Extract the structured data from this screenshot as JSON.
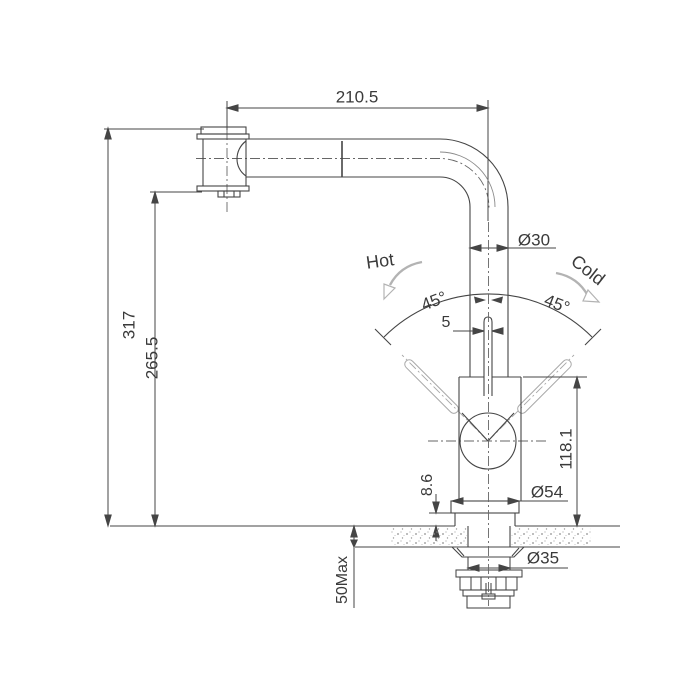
{
  "drawing": {
    "type": "faucet installation technical drawing",
    "labels": {
      "hot": "Hot",
      "cold": "Cold"
    },
    "dimensions": {
      "spout_reach": "210.5",
      "total_height": "317",
      "spout_height": "265.5",
      "pipe_diameter": "Ø30",
      "handle_width": "5",
      "handle_angle_left": "45°",
      "handle_angle_right": "45°",
      "body_height": "118.1",
      "flange_lip_height": "8.6",
      "flange_diameter": "Ø54",
      "shank_diameter": "Ø35",
      "counter_thickness": "50Max"
    },
    "colors": {
      "line": "#454545",
      "light_line": "#aaaaaa",
      "background": "#ffffff"
    }
  }
}
